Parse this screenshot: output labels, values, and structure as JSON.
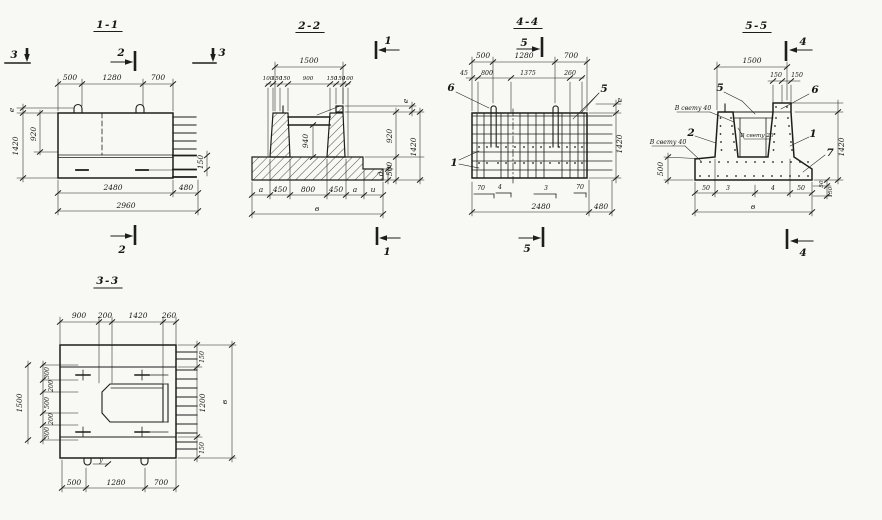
{
  "colors": {
    "paper": "#f8f8f4",
    "ink": "#1d1d1b"
  },
  "views": {
    "s11": {
      "title": "1-1",
      "m_left": "3",
      "m_right": "3",
      "m_top": "2",
      "m_bottom": "2",
      "top": [
        "500",
        "1280",
        "700"
      ],
      "e": "е",
      "d920": "920",
      "d1420": "1420",
      "d150": "150",
      "bottom": [
        "2480",
        "480",
        "2960"
      ]
    },
    "s22": {
      "title": "2-2",
      "m_top": "1",
      "m_bottom": "1",
      "d1500": "1500",
      "row2": [
        "100",
        "150",
        "150",
        "900",
        "150",
        "150",
        "100"
      ],
      "d940": "940",
      "e": "е",
      "d920": "920",
      "d500": "500",
      "d1420": "1420",
      "dd": "д",
      "bottom": [
        "а",
        "450",
        "800",
        "450",
        "а",
        "и"
      ],
      "width": "в"
    },
    "s44": {
      "title": "4-4",
      "m_top": "5",
      "m_bottom": "5",
      "top": [
        "500",
        "1280",
        "700"
      ],
      "row2": [
        "45",
        "800",
        "1375",
        "260"
      ],
      "c6": "6",
      "c5": "5",
      "c1": "1",
      "e": "е",
      "d1420": "1420",
      "brow1": [
        "70",
        "4",
        "3",
        "70"
      ],
      "brow2": [
        "2480",
        "480"
      ]
    },
    "s55": {
      "title": "5-5",
      "m_top": "4",
      "m_bottom": "4",
      "d1500": "1500",
      "row2": [
        "150",
        "150"
      ],
      "c5": "5",
      "c6": "6",
      "c2": "2",
      "c1": "1",
      "c7": "7",
      "clear40a": "В свету 40",
      "clear40b": "В свету 40",
      "clear20": "В свету 20",
      "d500": "500",
      "d1420": "1420",
      "corner": [
        "50",
        "150"
      ],
      "bottom": [
        "50",
        "3",
        "4",
        "50"
      ],
      "width": "в"
    },
    "s33": {
      "title": "3-3",
      "top": [
        "900",
        "200",
        "1420",
        "260"
      ],
      "left_total": "1500",
      "left": [
        "300",
        "200",
        "500",
        "200",
        "300"
      ],
      "right": [
        "150",
        "1200",
        "150"
      ],
      "width": "в",
      "u": "у",
      "bottom": [
        "500",
        "1280",
        "700"
      ]
    }
  }
}
